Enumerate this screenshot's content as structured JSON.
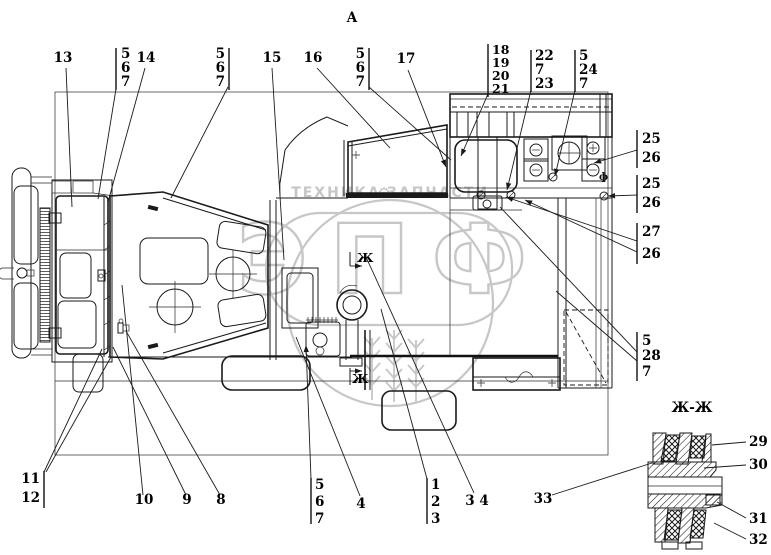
{
  "view_label": "А",
  "section_view": {
    "title": "Ж-Ж"
  },
  "section_marker": "Ж",
  "symbols": {
    "diameter": "ф"
  },
  "watermark": {
    "brand": "ЭПФ",
    "tagline_left": "ТЕХНИКА",
    "tagline_right": "ЗАПЧАСТИ",
    "gear": "⚙"
  },
  "callouts": {
    "c13": {
      "label": "13"
    },
    "c5a": {
      "items": [
        "5",
        "6",
        "7"
      ]
    },
    "c14": {
      "label": "14"
    },
    "c5b": {
      "items": [
        "5",
        "6",
        "7"
      ]
    },
    "c15": {
      "label": "15"
    },
    "c16": {
      "label": "16"
    },
    "c5c": {
      "items": [
        "5",
        "6",
        "7"
      ]
    },
    "c17": {
      "label": "17"
    },
    "c18": {
      "items": [
        "18",
        "19",
        "20",
        "21"
      ]
    },
    "c22": {
      "items": [
        "22",
        "7",
        "23"
      ]
    },
    "c24": {
      "items": [
        "5",
        "24",
        "7"
      ]
    },
    "c25a": {
      "items": [
        "25",
        "26"
      ]
    },
    "c25b": {
      "items": [
        "25",
        "26"
      ]
    },
    "c27": {
      "items": [
        "27",
        "26"
      ]
    },
    "c28": {
      "items": [
        "5",
        "28",
        "7"
      ]
    },
    "c11": {
      "items": [
        "11",
        "12"
      ]
    },
    "c10": {
      "label": "10"
    },
    "c9": {
      "label": "9"
    },
    "c8": {
      "label": "8"
    },
    "c5d": {
      "items": [
        "5",
        "6",
        "7"
      ]
    },
    "c4": {
      "label": "4"
    },
    "c1": {
      "items": [
        "1",
        "2",
        "3"
      ]
    },
    "c34": {
      "label": "3 4"
    },
    "c33": {
      "label": "33"
    },
    "c29": {
      "label": "29"
    },
    "c30": {
      "label": "30"
    },
    "c31": {
      "label": "31"
    },
    "c32": {
      "label": "32"
    }
  }
}
